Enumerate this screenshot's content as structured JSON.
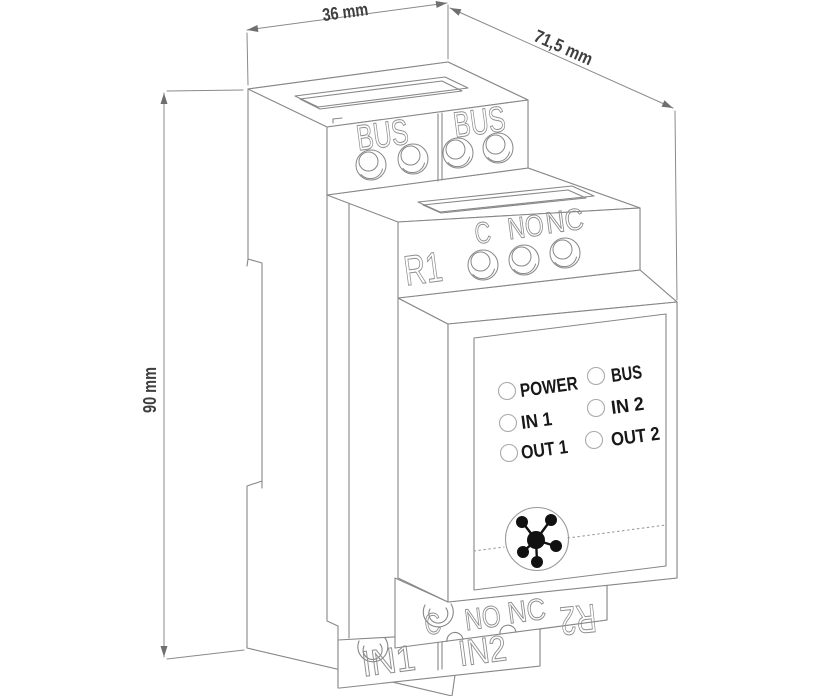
{
  "dimensions": {
    "width": "36 mm",
    "depth": "71,5 mm",
    "height": "90 mm"
  },
  "terminals": {
    "bus_labels": [
      "BUS",
      "BUS"
    ],
    "relay1": {
      "name": "R1",
      "contacts": [
        "C",
        "NO",
        "NC"
      ]
    },
    "relay2": {
      "name": "R2",
      "contacts": [
        "C",
        "NO",
        "NC"
      ]
    },
    "input_labels": [
      "IN1",
      "IN2"
    ]
  },
  "front_panel": {
    "led_labels_left": [
      "POWER",
      "IN 1",
      "OUT 1"
    ],
    "led_labels_right": [
      "BUS",
      "IN 2",
      "OUT 2"
    ]
  },
  "icons": {
    "logo": "hub-network-logo-icon"
  },
  "colors": {
    "background": "#ffffff",
    "line": "#878787",
    "engraved_text": "#8e8e8e",
    "dimension_text": "#3f3f3f",
    "led_label_text": "#181818",
    "logo": "#111111"
  }
}
